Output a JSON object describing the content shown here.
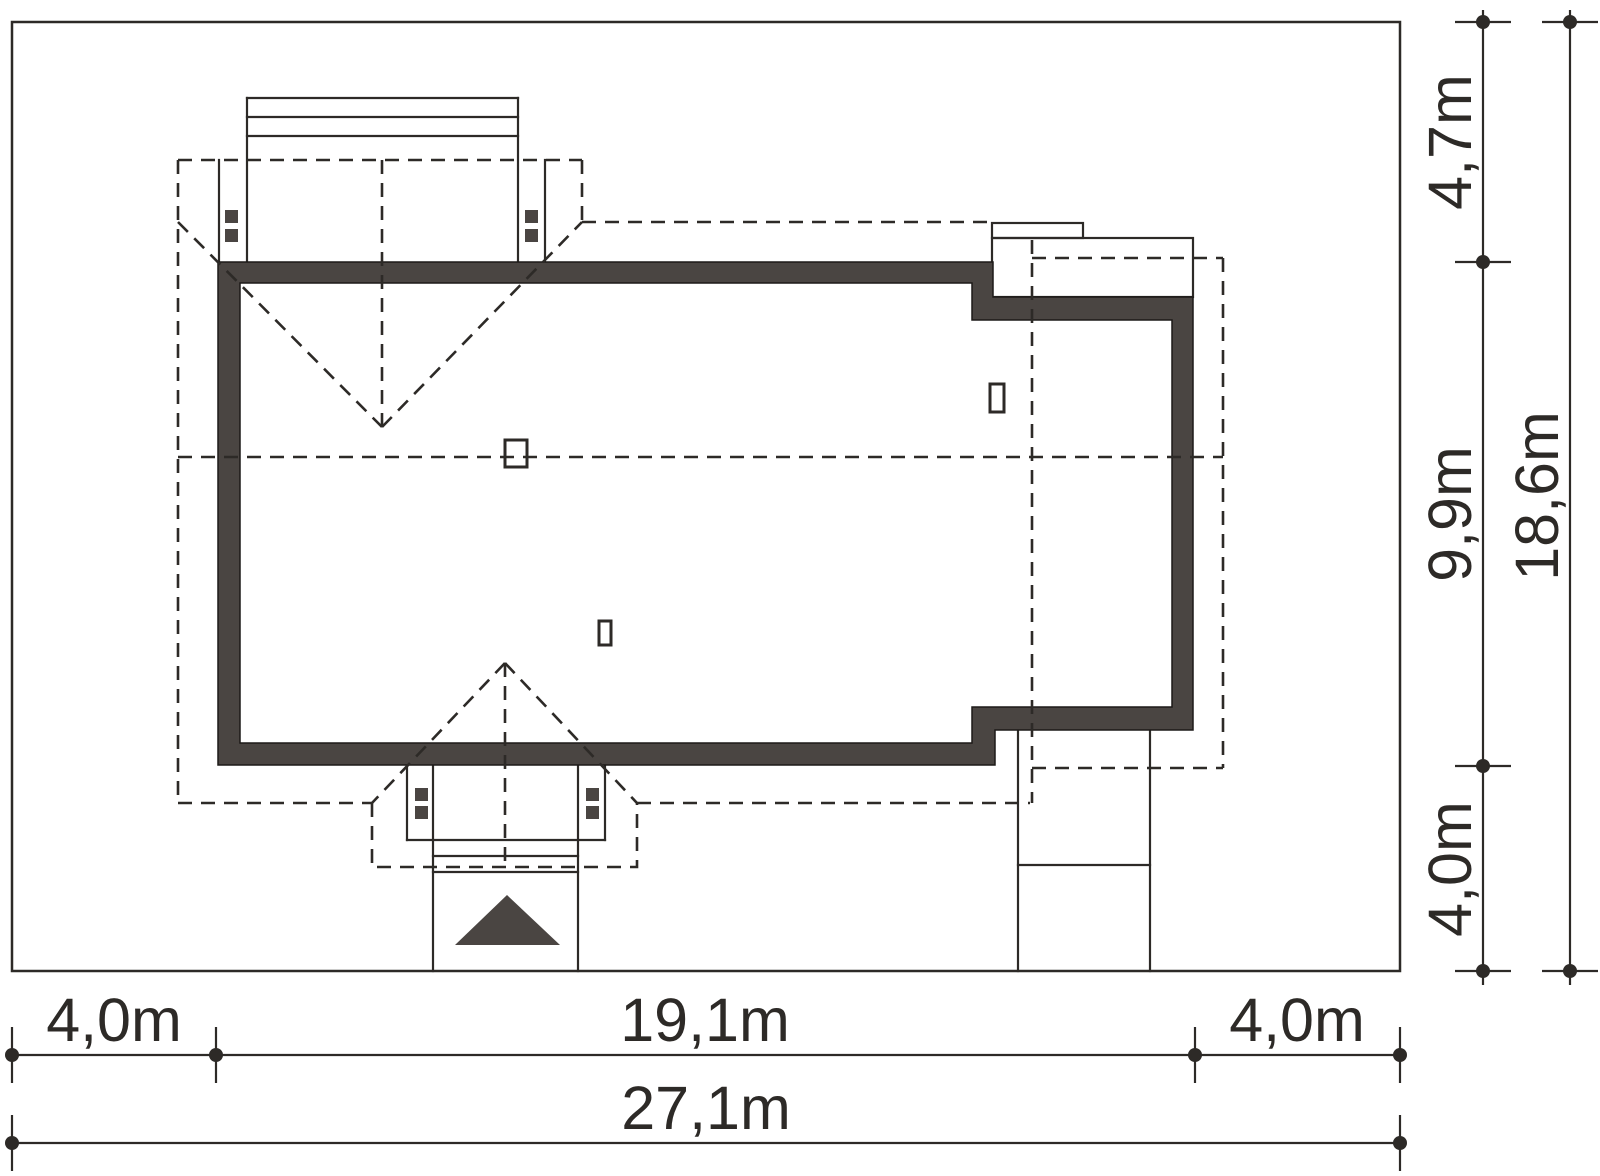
{
  "figure": {
    "type": "architectural-site-plan",
    "description": "Plot plan of a single-family house with roof outline (dashed), entrance dormer, garage dormer and side terrace"
  },
  "colors": {
    "background": "#ffffff",
    "line": "#2d2a27",
    "dark_fill": "#4a4542"
  },
  "dims": {
    "bottom": {
      "segments": [
        {
          "label": "4,0m",
          "value_m": 4.0
        },
        {
          "label": "19,1m",
          "value_m": 19.1
        },
        {
          "label": "4,0m",
          "value_m": 4.0
        }
      ],
      "total": {
        "label": "27,1m",
        "value_m": 27.1
      }
    },
    "right": {
      "segments": [
        {
          "label": "4,7m",
          "value_m": 4.7
        },
        {
          "label": "9,9m",
          "value_m": 9.9
        },
        {
          "label": "4,0m",
          "value_m": 4.0
        }
      ],
      "total": {
        "label": "18,6m",
        "value_m": 18.6
      }
    }
  }
}
